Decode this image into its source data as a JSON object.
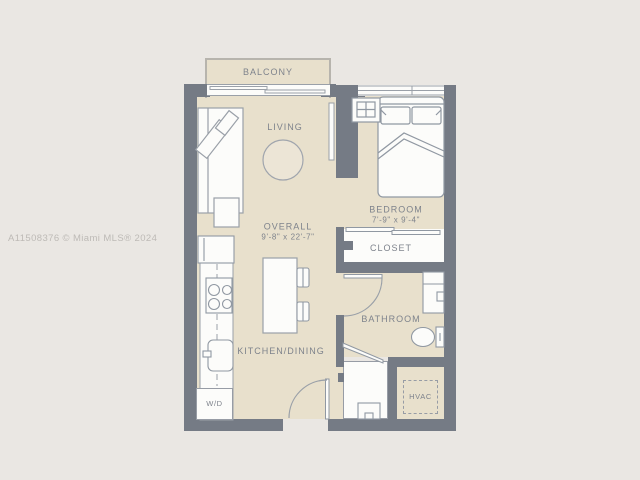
{
  "colors": {
    "background": "#eae7e3",
    "floor": "#e8e0cc",
    "wall": "#757b85",
    "fixture": "#fcfcfa",
    "outline": "#979ca5",
    "label": "#7e838c",
    "watermark": "#bdbab6"
  },
  "watermark": {
    "text": "A11508376 © Miami MLS® 2024"
  },
  "rooms": {
    "balcony": "BALCONY",
    "living": "LIVING",
    "overall": "OVERALL",
    "overall_dims": "9'-8\" x 22'-7\"",
    "bedroom": "BEDROOM",
    "bedroom_dims": "7'-9\" x 9'-4\"",
    "closet": "CLOSET",
    "bathroom": "BATHROOM",
    "kitchen_dining": "KITCHEN/DINING",
    "washer_dryer": "W/D",
    "hvac": "HVAC"
  },
  "icons": {
    "bed": "bed-icon",
    "nightstand": "nightstand-icon",
    "sofa": "sofa-icon",
    "round-table": "round-table-icon",
    "tv": "tv-icon",
    "island": "kitchen-island-icon",
    "stools": "stool-icon",
    "fridge": "fridge-icon",
    "stove": "stove-icon",
    "sink": "kitchen-sink-icon",
    "vanity": "vanity-sink-icon",
    "toilet": "toilet-icon",
    "water-heater": "water-heater-icon",
    "doors": "door-swing-icon",
    "window": "window-icon",
    "slider": "sliding-door-icon"
  }
}
